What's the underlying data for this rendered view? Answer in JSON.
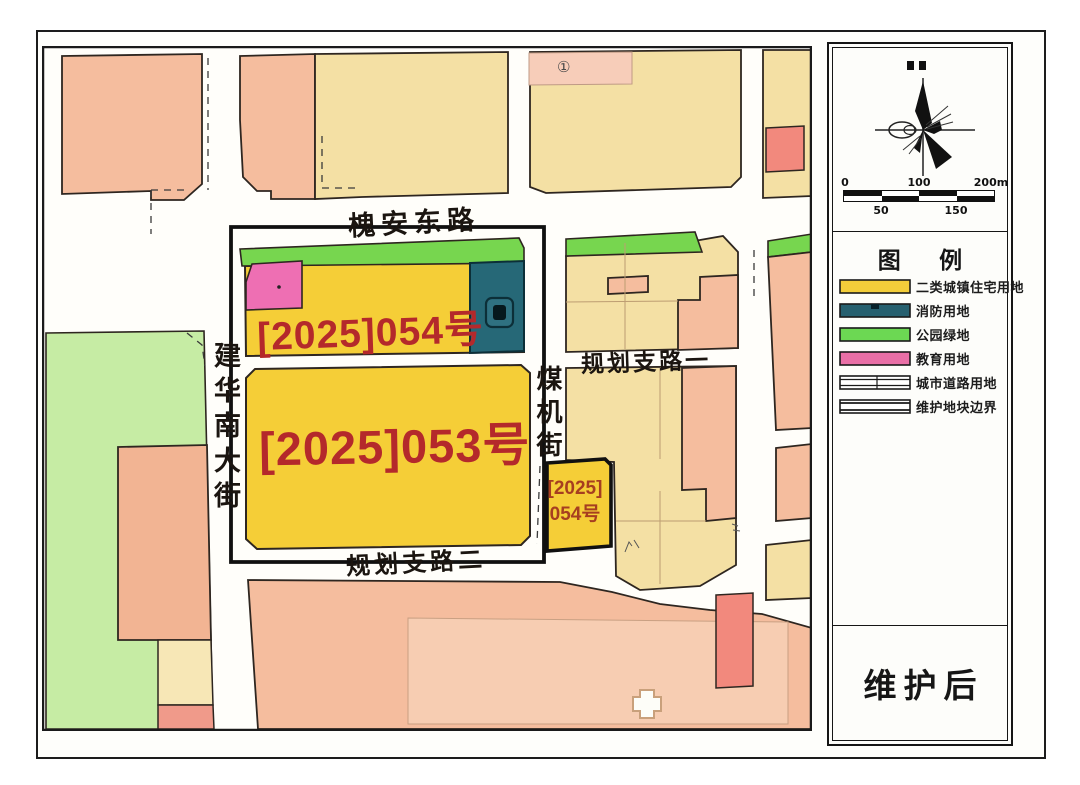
{
  "map": {
    "roads": {
      "huaian_east_road": "槐安东路",
      "jianhua_south_street": "建华南大街",
      "meiji_street": "煤机街",
      "planned_branch_road_1": "规划支路一",
      "planned_branch_road_2": "规划支路二"
    },
    "parcels": {
      "p053": "[2025]053号",
      "p054": "[2025]054号",
      "p154_line1": "[2025]",
      "p154_line2": "054号"
    },
    "circled_mark": "①"
  },
  "panel": {
    "legend_title": "图 例",
    "legend": {
      "items": [
        {
          "label": "二类城镇住宅用地",
          "color": "#F2CD3A",
          "swatch": "solid"
        },
        {
          "label": "消防用地",
          "color": "#26606F",
          "swatch": "solid"
        },
        {
          "label": "公园绿地",
          "color": "#6CD853",
          "swatch": "solid"
        },
        {
          "label": "教育用地",
          "color": "#E96FA6",
          "swatch": "solid"
        },
        {
          "label": "城市道路用地",
          "color": "#FFFFFF",
          "swatch": "road-pattern"
        },
        {
          "label": "维护地块边界",
          "color": "#FFFFFF",
          "swatch": "boundary-pattern"
        }
      ]
    },
    "scale_bar": {
      "top_labels": [
        "0",
        "100",
        "200m"
      ],
      "bottom_labels": [
        "50",
        "150"
      ]
    },
    "stamp": "维护后"
  },
  "colors": {
    "residential_yellow": "#F5CE37",
    "fire_station_teal": "#266877",
    "park_green": "#77D64F",
    "education_pink": "#EE6FB3",
    "salmon_block": "#F5BD9E",
    "tan_block": "#F4E0A4",
    "large_green_block": "#C6ECA4",
    "red_block": "#F2897D",
    "parcel_text_red": "#B4292B",
    "road_white": "#FFFFFF"
  }
}
